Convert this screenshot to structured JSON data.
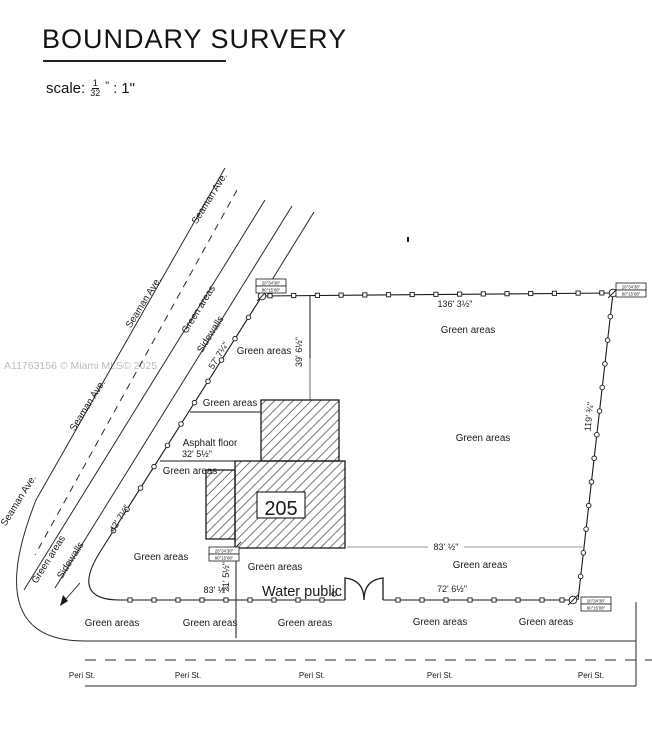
{
  "title": "BOUNDARY SURVERY",
  "scale": {
    "label": "scale:",
    "fraction_numerator": "1",
    "fraction_denominator": "32",
    "fraction_unit": "\"",
    "separator": ":",
    "value": "1\""
  },
  "watermark": "A11763156 © Miami MLS© 2025",
  "streets": {
    "seaman_ave": "Seaman Ave.",
    "peri_st": "Peri St."
  },
  "labels": {
    "green_areas": "Green areas",
    "sidewalls": "Sidewalls",
    "asphalt_floor": "Asphalt floor",
    "water_public": "Water public"
  },
  "building": {
    "number": "205"
  },
  "dimensions": {
    "top_boundary": "136' 3½\"",
    "offset_north": "39' 6½\"",
    "west_upper": "57' 7¼\"",
    "west_lower": "42' 7¼\"",
    "east_boundary": "119' ¾\"",
    "mid_width": "83' ½\"",
    "bottom_left": "83' ½\"",
    "offset_south": "21' 5½\"",
    "bottom_right": "72' 6½\"",
    "asphalt_width": "32' 5½\""
  },
  "bearing_boxes": {
    "row1": "20°34'38\"",
    "row2": "80°15'08\""
  }
}
